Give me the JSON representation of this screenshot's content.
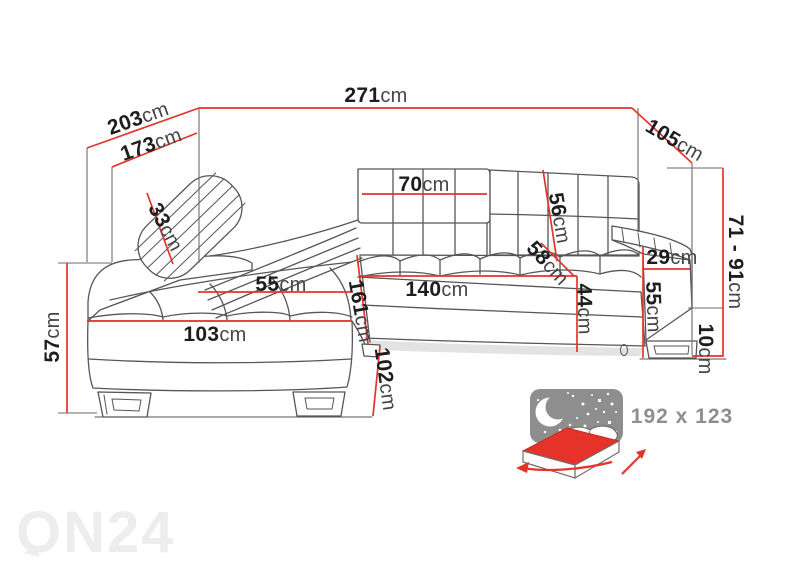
{
  "colors": {
    "accent": "#e5332a",
    "line": "#565656",
    "text": "#1d1d1d",
    "unit": "#454545",
    "muted": "#8e8e8e",
    "wm": "#ededed",
    "shadow": "#d4d4d4"
  },
  "dims": {
    "d271": {
      "value": "271",
      "unit": "cm"
    },
    "d203": {
      "value": "203",
      "unit": "cm"
    },
    "d173": {
      "value": "173",
      "unit": "cm"
    },
    "d105": {
      "value": "105",
      "unit": "cm"
    },
    "d33": {
      "value": "33",
      "unit": "cm"
    },
    "d70": {
      "value": "70",
      "unit": "cm"
    },
    "d56": {
      "value": "56",
      "unit": "cm"
    },
    "d58": {
      "value": "58",
      "unit": "cm"
    },
    "d29": {
      "value": "29",
      "unit": "cm"
    },
    "d55_chaise": {
      "value": "55",
      "unit": "cm"
    },
    "d140": {
      "value": "140",
      "unit": "cm"
    },
    "d161": {
      "value": "161",
      "unit": "cm"
    },
    "d44": {
      "value": "44",
      "unit": "cm"
    },
    "d55_arm": {
      "value": "55",
      "unit": "cm"
    },
    "d71_91": {
      "value": "71 - 91",
      "unit": "cm"
    },
    "d10": {
      "value": "10",
      "unit": "cm"
    },
    "d103": {
      "value": "103",
      "unit": "cm"
    },
    "d102": {
      "value": "102",
      "unit": "cm"
    },
    "d57": {
      "value": "57",
      "unit": "cm"
    }
  },
  "bed": {
    "size": "192 x 123"
  },
  "watermark": {
    "text": "ON24"
  }
}
